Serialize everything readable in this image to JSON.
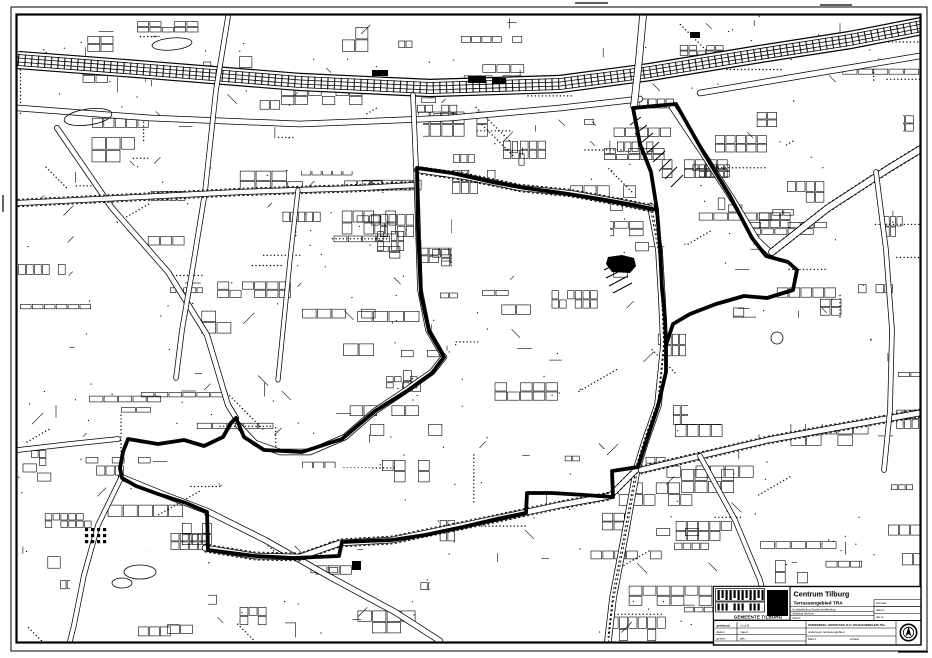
{
  "titleblock": {
    "project_title": "Centrum Tilburg",
    "subtitle": "Terrassengebied TRA",
    "org": "GEMEENTE TILBURG",
    "micro_left": [
      "hoofdafdeling Stadsontwikkeling",
      "afdeling Verkeer",
      "dienst"
    ],
    "micro_right": [
      "formaat",
      "datum",
      "tek.nr."
    ],
    "table_left": [
      "getekend",
      "datum",
      "gezien"
    ],
    "table_left2": [
      "J.v.d.B.",
      "maart",
      "akk."
    ],
    "table_mid_header": "ONDERDEEL   HOOFDAFD. R.O. EN BOUWBELEID TEL.",
    "table_mid_rows": [
      "onderwerp  terrassengebied",
      "blad 1",
      "schaal"
    ],
    "stamp": "N"
  },
  "map": {
    "ink": "#000000",
    "paper": "#ffffff",
    "frame_outer": [
      11,
      7,
      916,
      644
    ],
    "frame_inner": [
      16.5,
      14.5,
      904,
      628
    ],
    "ticks": [
      [
        575,
        3,
        608,
        3
      ],
      [
        820,
        5,
        852,
        5
      ],
      [
        898,
        652,
        928,
        652
      ],
      [
        3,
        195,
        3,
        212
      ]
    ],
    "boundary_width": 3.8,
    "boundary": [
      [
        633,
        108
      ],
      [
        676,
        104
      ],
      [
        702,
        150
      ],
      [
        730,
        196
      ],
      [
        752,
        238
      ],
      [
        766,
        256
      ],
      [
        788,
        262
      ],
      [
        797,
        270
      ],
      [
        793,
        290
      ],
      [
        767,
        298
      ],
      [
        744,
        296
      ],
      [
        716,
        304
      ],
      [
        690,
        314
      ],
      [
        673,
        324
      ],
      [
        666,
        345
      ],
      [
        666,
        372
      ],
      [
        658,
        406
      ],
      [
        646,
        442
      ],
      [
        638,
        467
      ],
      [
        612,
        471
      ],
      [
        613,
        497
      ],
      [
        585,
        495
      ],
      [
        552,
        493
      ],
      [
        527,
        493
      ],
      [
        526,
        513
      ],
      [
        497,
        519
      ],
      [
        463,
        527
      ],
      [
        425,
        535
      ],
      [
        392,
        540
      ],
      [
        342,
        542
      ],
      [
        339,
        556
      ],
      [
        294,
        558
      ],
      [
        255,
        556
      ],
      [
        208,
        550
      ],
      [
        207,
        512
      ],
      [
        186,
        503
      ],
      [
        158,
        494
      ],
      [
        136,
        486
      ],
      [
        122,
        478
      ],
      [
        120,
        468
      ],
      [
        123,
        452
      ],
      [
        128,
        439
      ],
      [
        158,
        444
      ],
      [
        184,
        440
      ],
      [
        204,
        446
      ],
      [
        223,
        437
      ],
      [
        231,
        423
      ],
      [
        236,
        418
      ],
      [
        244,
        437
      ],
      [
        264,
        450
      ],
      [
        302,
        452
      ],
      [
        342,
        439
      ],
      [
        375,
        411
      ],
      [
        407,
        391
      ],
      [
        432,
        373
      ],
      [
        444,
        357
      ],
      [
        429,
        331
      ],
      [
        421,
        295
      ],
      [
        418,
        230
      ],
      [
        417,
        168
      ],
      [
        452,
        173
      ],
      [
        492,
        182
      ],
      [
        525,
        188
      ],
      [
        562,
        193
      ],
      [
        600,
        199
      ],
      [
        634,
        205
      ],
      [
        657,
        210
      ],
      [
        651,
        172
      ],
      [
        640,
        144
      ],
      [
        633,
        108
      ]
    ],
    "boundary_spur": [
      [
        657,
        210
      ],
      [
        660,
        248
      ],
      [
        662,
        288
      ],
      [
        665,
        318
      ],
      [
        666,
        345
      ]
    ],
    "railway": {
      "pts": [
        [
          18,
          60
        ],
        [
          150,
          70
        ],
        [
          300,
          82
        ],
        [
          430,
          88
        ],
        [
          560,
          84
        ],
        [
          650,
          72
        ],
        [
          760,
          54
        ],
        [
          850,
          40
        ],
        [
          922,
          26
        ]
      ],
      "band": 16
    },
    "roads": [
      {
        "w": 5,
        "dots": false,
        "pts": [
          [
            18,
            108
          ],
          [
            150,
            118
          ],
          [
            300,
            124
          ],
          [
            450,
            118
          ],
          [
            560,
            108
          ],
          [
            640,
            99
          ]
        ]
      },
      {
        "w": 5,
        "dots": false,
        "pts": [
          [
            700,
            93
          ],
          [
            800,
            76
          ],
          [
            920,
            56
          ]
        ]
      },
      {
        "w": 6,
        "dots": false,
        "pts": [
          [
            643,
            16
          ],
          [
            639,
            60
          ],
          [
            634,
            106
          ]
        ]
      },
      {
        "w": 6,
        "dots": true,
        "pts": [
          [
            651,
            207
          ],
          [
            659,
            250
          ],
          [
            662,
            300
          ],
          [
            664,
            345
          ],
          [
            658,
            405
          ],
          [
            645,
            442
          ],
          [
            637,
            468
          ],
          [
            624,
            540
          ],
          [
            613,
            598
          ],
          [
            608,
            641
          ]
        ]
      },
      {
        "w": 5,
        "dots": false,
        "pts": [
          [
            672,
            107
          ],
          [
            702,
            152
          ],
          [
            733,
            200
          ],
          [
            757,
            240
          ],
          [
            771,
            253
          ]
        ]
      },
      {
        "w": 6,
        "dots": true,
        "pts": [
          [
            772,
            252
          ],
          [
            828,
            208
          ],
          [
            888,
            169
          ],
          [
            924,
            147
          ]
        ]
      },
      {
        "w": 4.5,
        "dots": false,
        "pts": [
          [
            57,
            128
          ],
          [
            112,
            208
          ],
          [
            168,
            272
          ],
          [
            207,
            335
          ],
          [
            228,
            405
          ],
          [
            236,
            418
          ]
        ]
      },
      {
        "w": 4,
        "dots": false,
        "pts": [
          [
            228,
            17
          ],
          [
            216,
            90
          ],
          [
            205,
            192
          ],
          [
            191,
            278
          ],
          [
            182,
            330
          ],
          [
            176,
            378
          ]
        ]
      },
      {
        "w": 4.5,
        "dots": true,
        "pts": [
          [
            18,
            203
          ],
          [
            120,
            198
          ],
          [
            240,
            192
          ],
          [
            360,
            188
          ],
          [
            416,
            185
          ]
        ]
      },
      {
        "w": 4,
        "dots": false,
        "pts": [
          [
            18,
            450
          ],
          [
            70,
            444
          ],
          [
            118,
            439
          ]
        ]
      },
      {
        "w": 5,
        "dots": false,
        "pts": [
          [
            121,
            477
          ],
          [
            165,
            495
          ],
          [
            207,
            511
          ],
          [
            265,
            540
          ],
          [
            330,
            577
          ],
          [
            395,
            612
          ],
          [
            440,
            641
          ]
        ]
      },
      {
        "w": 5,
        "dots": true,
        "pts": [
          [
            205,
            548
          ],
          [
            255,
            556
          ],
          [
            300,
            557
          ],
          [
            340,
            543
          ],
          [
            392,
            540
          ],
          [
            470,
            524
          ],
          [
            527,
            512
          ],
          [
            560,
            505
          ],
          [
            610,
            496
          ],
          [
            637,
            469
          ]
        ]
      },
      {
        "w": 4,
        "dots": false,
        "pts": [
          [
            413,
            95
          ],
          [
            416,
            167
          ],
          [
            420,
            290
          ],
          [
            428,
            330
          ],
          [
            443,
            356
          ]
        ]
      },
      {
        "w": 4.5,
        "dots": true,
        "pts": [
          [
            417,
            170
          ],
          [
            466,
            177
          ],
          [
            520,
            188
          ],
          [
            570,
            193
          ],
          [
            620,
            202
          ],
          [
            650,
            208
          ]
        ]
      },
      {
        "w": 5,
        "dots": true,
        "pts": [
          [
            641,
            470
          ],
          [
            700,
            456
          ],
          [
            768,
            440
          ],
          [
            840,
            427
          ],
          [
            920,
            413
          ]
        ]
      },
      {
        "w": 4,
        "dots": false,
        "pts": [
          [
            121,
            478
          ],
          [
            98,
            525
          ],
          [
            84,
            575
          ],
          [
            74,
            625
          ],
          [
            70,
            641
          ]
        ]
      },
      {
        "w": 5,
        "dots": false,
        "pts": [
          [
            238,
            425
          ],
          [
            255,
            443
          ],
          [
            280,
            452
          ],
          [
            310,
            452
          ],
          [
            345,
            437
          ],
          [
            375,
            411
          ],
          [
            405,
            391
          ],
          [
            432,
            372
          ],
          [
            444,
            357
          ]
        ]
      },
      {
        "w": 4,
        "dots": false,
        "pts": [
          [
            876,
            172
          ],
          [
            886,
            250
          ],
          [
            892,
            330
          ],
          [
            890,
            410
          ],
          [
            884,
            470
          ]
        ]
      },
      {
        "w": 4,
        "dots": false,
        "pts": [
          [
            700,
            456
          ],
          [
            735,
            520
          ],
          [
            760,
            580
          ],
          [
            775,
            640
          ]
        ]
      },
      {
        "w": 3.5,
        "dots": false,
        "pts": [
          [
            298,
            190
          ],
          [
            290,
            260
          ],
          [
            283,
            330
          ],
          [
            278,
            380
          ]
        ]
      }
    ],
    "clearings": [
      [
        452,
        196,
        158,
        80
      ],
      [
        688,
        318,
        178,
        106
      ],
      [
        295,
        115,
        128,
        56
      ],
      [
        70,
        552,
        138,
        72
      ],
      [
        222,
        468,
        150,
        66
      ],
      [
        430,
        562,
        168,
        68
      ],
      [
        795,
        82,
        108,
        62
      ]
    ],
    "hatch": [
      [
        630,
        125,
        641,
        117
      ],
      [
        635,
        134,
        647,
        125
      ],
      [
        641,
        143,
        653,
        133
      ],
      [
        647,
        153,
        659,
        142
      ],
      [
        653,
        162,
        665,
        151
      ],
      [
        659,
        171,
        671,
        159
      ],
      [
        665,
        179,
        677,
        167
      ],
      [
        671,
        187,
        683,
        175
      ],
      [
        604,
        270,
        620,
        262
      ],
      [
        606,
        278,
        624,
        269
      ],
      [
        609,
        286,
        628,
        276
      ],
      [
        613,
        293,
        632,
        283
      ]
    ],
    "blobs": [
      [
        [
          608,
          257
        ],
        [
          622,
          255
        ],
        [
          634,
          258
        ],
        [
          636,
          266
        ],
        [
          630,
          273
        ],
        [
          612,
          272
        ],
        [
          606,
          264
        ]
      ]
    ],
    "black_squares": [
      [
        352,
        561,
        9,
        9
      ],
      [
        468,
        76,
        18,
        7
      ],
      [
        492,
        78,
        14,
        6
      ],
      [
        372,
        70,
        16,
        6
      ],
      [
        690,
        32,
        10,
        6
      ]
    ],
    "grid_block": [
      85,
      528,
      4,
      3
    ],
    "ellipses": [
      [
        88,
        117,
        24,
        8,
        -8
      ],
      [
        172,
        44,
        20,
        6,
        -5
      ],
      [
        140,
        572,
        16,
        7,
        0
      ],
      [
        122,
        583,
        10,
        5,
        0
      ],
      [
        777,
        338,
        6,
        6,
        0
      ]
    ]
  }
}
